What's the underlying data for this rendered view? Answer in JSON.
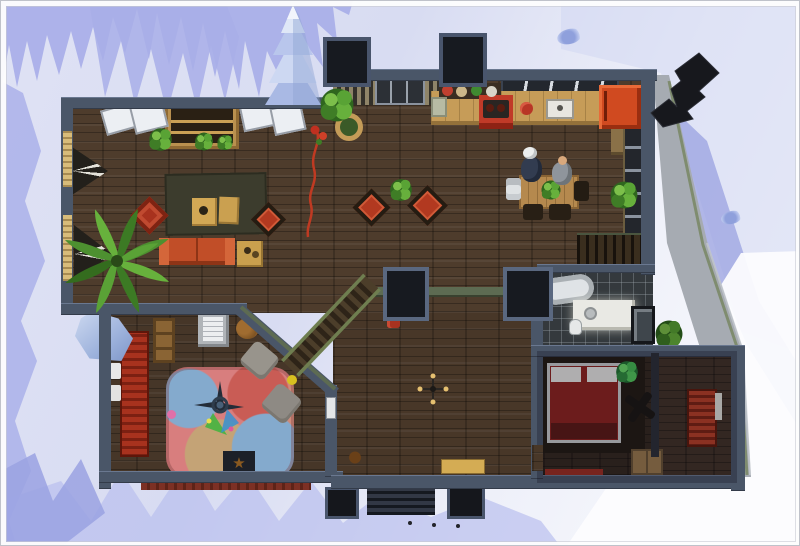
{
  "app": {
    "name": "The Sims 4",
    "view": "top-down dollhouse floor-plan view",
    "setting": "snow-covered winter lot"
  },
  "colors": {
    "wall": "#4a5668",
    "wallLight": "#6a7890",
    "wallDark": "#333b49",
    "wallBlack": "#171a20",
    "wood": "#4e3c2c",
    "woodBed": "#342920",
    "tile": "#34393d",
    "counter": "#c69c58",
    "red": "#b23920",
    "sofa": "#c14e28",
    "fridge": "#d04a20",
    "rug": "#3c3c2d",
    "shadow": "#a8aee8",
    "shadowSoft": "#b9bfee",
    "stairRail": "#6f7e50",
    "hallWallTop": "#5d6b52",
    "playPink": "#d87e7e",
    "playBlue": "#84aacd",
    "playTan": "#c4a376",
    "playRed": "#c95c55"
  },
  "scene": {
    "environment": [
      "snow terrain",
      "blue tree shadows on snow",
      "snowy spruce tree",
      "ice boulder",
      "black rooftop chimney vane",
      "two black chimneys",
      "porch steps with planters"
    ],
    "sims_visible": 2,
    "rooms": [
      {
        "name": "living-room",
        "items": [
          "olive area rug",
          "two wood coffee tables",
          "red tufted ottoman",
          "red armchair",
          "orange sofa",
          "side table",
          "wall bookcase",
          "large palm plant",
          "potted plants",
          "two dark cone lamps",
          "tan curtains",
          "white skylight windows"
        ]
      },
      {
        "name": "kitchen",
        "items": [
          "wood counter",
          "red stove",
          "sink",
          "red fridge",
          "green trash can",
          "decorative wall plates",
          "greenhouse window band",
          "glass entry door"
        ]
      },
      {
        "name": "dining-area",
        "items": [
          "wood dining table",
          "plant centerpiece",
          "dish stack",
          "three dark chairs",
          "potted plant",
          "two standing sims"
        ]
      },
      {
        "name": "hallway",
        "items": [
          "two red armchairs",
          "potted plant",
          "two black columns",
          "diagonal staircase",
          "red hydrant",
          "ceiling light",
          "yellow doormat",
          "upper staircase",
          "red climbing rope decal"
        ]
      },
      {
        "name": "kids-room",
        "items": [
          "red slatted bed",
          "toy shelf",
          "desk with paper",
          "teddy bear",
          "patchwork play rug",
          "gyroscope toy",
          "star mat",
          "two gray beanbag chairs",
          "white door"
        ]
      },
      {
        "name": "bathroom",
        "items": [
          "bathtub",
          "white vanity with sink",
          "toilet",
          "glass shower"
        ]
      },
      {
        "name": "bedroom",
        "items": [
          "double bed with red blanket",
          "dark rug",
          "ceiling fan",
          "potted plant",
          "red runner rug"
        ]
      },
      {
        "name": "closet-room",
        "items": [
          "red slatted dresser",
          "cardboard box"
        ]
      }
    ]
  }
}
